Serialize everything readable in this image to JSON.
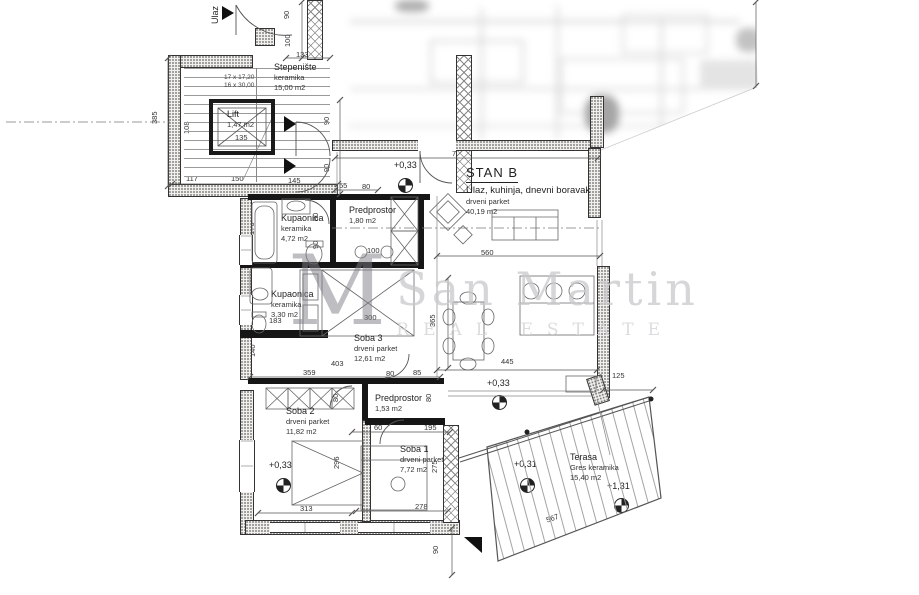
{
  "watermark": {
    "monogram": "M",
    "line1": "San Martin",
    "line2": "REAL ESTATE"
  },
  "plan": {
    "rooms": [
      {
        "id": "ulaz",
        "name": "Ulaz"
      },
      {
        "id": "stepeniste",
        "name": "Stepenište",
        "material": "keramika",
        "area": "15,00 m2"
      },
      {
        "id": "lift",
        "name": "Lift",
        "area": "1,47 m2"
      },
      {
        "id": "stan-b",
        "name": "STAN B",
        "desc": "Ulaz, kuhinja, dnevni boravak",
        "material": "drveni parket",
        "area": "40,19 m2"
      },
      {
        "id": "kupaonica-1",
        "name": "Kupaonica",
        "material": "keramika",
        "area": "4,72 m2"
      },
      {
        "id": "predprostor-1",
        "name": "Predprostor",
        "area": "1,80 m2"
      },
      {
        "id": "kupaonica-2",
        "name": "Kupaonica",
        "material": "keramika",
        "area": "3,30 m2"
      },
      {
        "id": "soba-3",
        "name": "Soba 3",
        "material": "drveni parket",
        "area": "12,61 m2"
      },
      {
        "id": "predprostor-2",
        "name": "Predprostor",
        "area": "1,53 m2"
      },
      {
        "id": "soba-2",
        "name": "Soba 2",
        "material": "drveni parket",
        "area": "11,82 m2"
      },
      {
        "id": "soba-1",
        "name": "Soba 1",
        "material": "drveni parket",
        "area": "7,72 m2"
      },
      {
        "id": "terasa",
        "name": "Terasa",
        "material": "Gres keramika",
        "area": "15,40 m2"
      }
    ],
    "stair_note": [
      "17 x 17,20",
      "16 x 30,00"
    ],
    "elevations": [
      {
        "label": "+0,33",
        "lx": 394,
        "ly": 160,
        "cx": 406,
        "cy": 186
      },
      {
        "label": "+0,33",
        "lx": 487,
        "ly": 378,
        "cx": 500,
        "cy": 403
      },
      {
        "label": "+0,33",
        "lx": 269,
        "ly": 460,
        "cx": 284,
        "cy": 486
      },
      {
        "label": "+0,31",
        "lx": 514,
        "ly": 459,
        "cx": 528,
        "cy": 486
      },
      {
        "label": "+1,31",
        "lx": 607,
        "ly": 481,
        "cx": 622,
        "cy": 506
      }
    ],
    "dimensions": [
      {
        "t": "90",
        "x": 291,
        "y": 10,
        "r": 90
      },
      {
        "t": "100",
        "x": 292,
        "y": 38,
        "r": 90
      },
      {
        "t": "133",
        "x": 296,
        "y": 50,
        "r": 0
      },
      {
        "t": "385",
        "x": 159,
        "y": 115,
        "r": 90
      },
      {
        "t": "108",
        "x": 191,
        "y": 125,
        "r": 90
      },
      {
        "t": "135",
        "x": 235,
        "y": 133,
        "r": 0
      },
      {
        "t": "117",
        "x": 186,
        "y": 174,
        "r": 0
      },
      {
        "t": "150",
        "x": 231,
        "y": 174,
        "r": 0
      },
      {
        "t": "145",
        "x": 288,
        "y": 176,
        "r": 0
      },
      {
        "t": "90",
        "x": 331,
        "y": 116,
        "r": 90
      },
      {
        "t": "90",
        "x": 331,
        "y": 163,
        "r": 90
      },
      {
        "t": "725",
        "x": 452,
        "y": 149,
        "r": 0
      },
      {
        "t": "55",
        "x": 339,
        "y": 181,
        "r": 0
      },
      {
        "t": "80",
        "x": 362,
        "y": 182,
        "r": 0
      },
      {
        "t": "176",
        "x": 256,
        "y": 226,
        "r": 90
      },
      {
        "t": "80",
        "x": 320,
        "y": 212,
        "r": 90
      },
      {
        "t": "90",
        "x": 320,
        "y": 240,
        "r": 90
      },
      {
        "t": "100",
        "x": 367,
        "y": 246,
        "r": 0
      },
      {
        "t": "560",
        "x": 481,
        "y": 248,
        "r": 0
      },
      {
        "t": "365",
        "x": 437,
        "y": 318,
        "r": 90
      },
      {
        "t": "300",
        "x": 364,
        "y": 313,
        "r": 0
      },
      {
        "t": "183",
        "x": 269,
        "y": 316,
        "r": 0
      },
      {
        "t": "140",
        "x": 257,
        "y": 348,
        "r": 90
      },
      {
        "t": "359",
        "x": 303,
        "y": 368,
        "r": 0
      },
      {
        "t": "403",
        "x": 331,
        "y": 359,
        "r": 0
      },
      {
        "t": "80",
        "x": 386,
        "y": 369,
        "r": 0
      },
      {
        "t": "85",
        "x": 413,
        "y": 368,
        "r": 0
      },
      {
        "t": "445",
        "x": 501,
        "y": 357,
        "r": 0
      },
      {
        "t": "125",
        "x": 612,
        "y": 371,
        "r": 0
      },
      {
        "t": "80",
        "x": 340,
        "y": 393,
        "r": 90
      },
      {
        "t": "80",
        "x": 433,
        "y": 393,
        "r": 90
      },
      {
        "t": "60",
        "x": 374,
        "y": 423,
        "r": 0
      },
      {
        "t": "195",
        "x": 424,
        "y": 423,
        "r": 0
      },
      {
        "t": "375",
        "x": 255,
        "y": 444,
        "r": 90
      },
      {
        "t": "296",
        "x": 341,
        "y": 460,
        "r": 90
      },
      {
        "t": "275",
        "x": 439,
        "y": 464,
        "r": 90
      },
      {
        "t": "313",
        "x": 300,
        "y": 504,
        "r": 0
      },
      {
        "t": "278",
        "x": 415,
        "y": 502,
        "r": 0
      },
      {
        "t": "90",
        "x": 440,
        "y": 545,
        "r": 90
      },
      {
        "t": "567",
        "x": 545,
        "y": 516,
        "r": -19
      }
    ]
  }
}
